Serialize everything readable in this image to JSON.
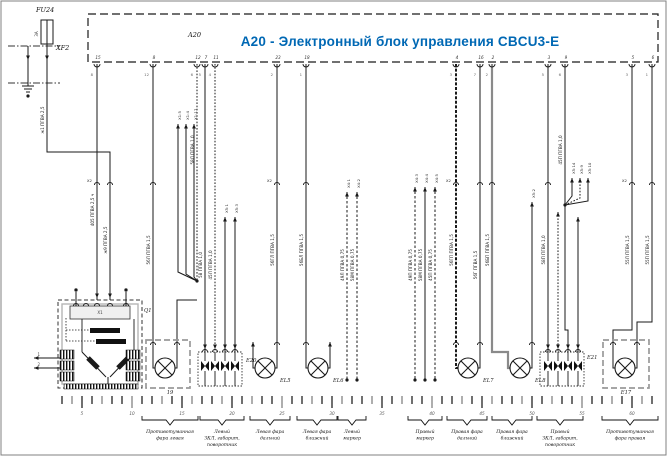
{
  "header": {
    "ref": "A20",
    "title": "A20 - Электронный блок управления CBCU3-E"
  },
  "fuse": {
    "ref": "FU24",
    "value": "3А",
    "conn": "XF2"
  },
  "relay": {
    "ref": "Q1",
    "top": "Х1",
    "left1": "1",
    "left2": "2"
  },
  "components": {
    "fog_left": "19",
    "led_left": "E20",
    "high_left": "EL5",
    "low_left": "EL6",
    "high_right": "EL7",
    "low_right": "EL8",
    "led_right": "E21",
    "fog_right": "E17"
  },
  "pins": [
    {
      "n": "15",
      "s": "8"
    },
    {
      "n": "8",
      "s": "12"
    },
    {
      "n": "12",
      "s": "6"
    },
    {
      "n": "7",
      "s": "5"
    },
    {
      "n": "11",
      "s": "4"
    },
    {
      "n": "23",
      "s": "2"
    },
    {
      "n": "18",
      "s": "1"
    },
    {
      "n": "4",
      "s": "3"
    },
    {
      "n": "16",
      "s": "7"
    },
    {
      "n": "2",
      "s": "2"
    },
    {
      "n": "3",
      "s": "5"
    },
    {
      "n": "9",
      "s": "6"
    },
    {
      "n": "5",
      "s": "3"
    },
    {
      "n": "6",
      "s": "1"
    }
  ],
  "wire_specs": [
    "ж1 ПГВА 2,5",
    "405 ПГВА 2,5 ч",
    "ж9 ПГВА 2,5",
    "56Л ПГВА 1,5",
    "58Л ПГВА 1,0",
    "58 ПГВА 1,0",
    "45Л ПГВА 1,0",
    "56ГЛ ПГВА 1,5",
    "56БЛ ПГВА 1,5",
    "49Л ПГВА 0,75",
    "58М ПГВА 0,75",
    "49П ПГВА 0,75",
    "58М ПГВА 0,75",
    "45П ПГВА 0,75",
    "56ГП ПГВА 1,5",
    "56Г ПГВА 1,5",
    "56БП ПГВА 1,5",
    "58П ПГВА 1,0",
    "45П ПГВА 1,0",
    "55Л ПГВА 1,5",
    "55П ПГВА 1,5"
  ],
  "arrow_labels": [
    "X1:5",
    "X1:4",
    "X1:17",
    "X5:1",
    "X5:3",
    "X4:1",
    "X4:2",
    "X4:3",
    "X4:4",
    "X4:5",
    "X5:2",
    "X5:14",
    "X5:9",
    "X5:10"
  ],
  "harness_labels": [
    "Х2",
    "Х2",
    "Х2",
    "Х2"
  ],
  "ruler": {
    "numbers": [
      "5",
      "10",
      "15",
      "20",
      "25",
      "30",
      "35",
      "40",
      "45",
      "50",
      "55",
      "60"
    ]
  },
  "brackets": [
    {
      "lines": [
        "Противотуманная",
        "фара левая"
      ]
    },
    {
      "lines": [
        "Левый",
        "ЗКЛ, габарит,",
        "поворотник"
      ]
    },
    {
      "lines": [
        "Левая фара",
        "дальний"
      ]
    },
    {
      "lines": [
        "Левая фара",
        "ближний"
      ]
    },
    {
      "lines": [
        "Левый",
        "маркер"
      ]
    },
    {
      "lines": [
        "Правый",
        "маркер"
      ]
    },
    {
      "lines": [
        "Правая фара",
        "дальний"
      ]
    },
    {
      "lines": [
        "Правая фара",
        "ближний"
      ]
    },
    {
      "lines": [
        "Правый",
        "ЗКЛ, габарит,",
        "поворотник"
      ]
    },
    {
      "lines": [
        "Противотуманная",
        "фара правая"
      ]
    }
  ],
  "colors": {
    "line": "#1a1a1a",
    "gray_wire": "#8a8a8a",
    "box_gray": "#9a9a9a",
    "accent": "#0068b4"
  }
}
